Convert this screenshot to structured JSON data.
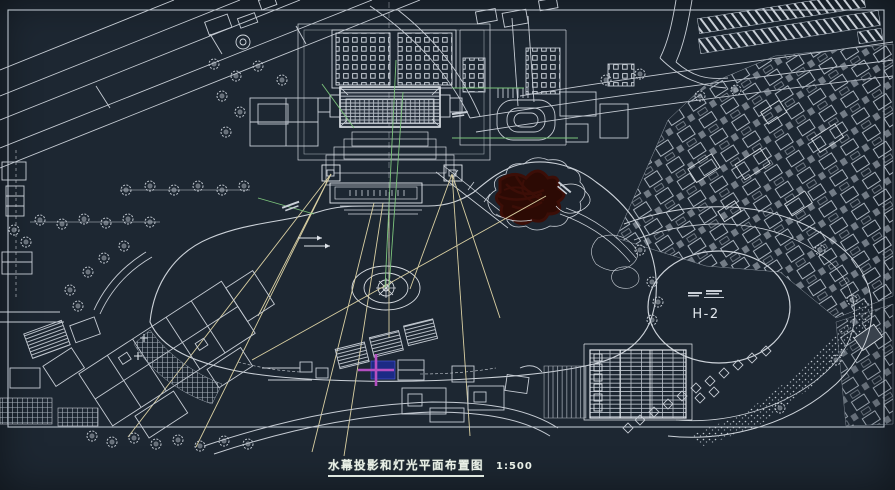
{
  "sheet": {
    "background": "#1d2732",
    "frame_color": "#b9c1ca"
  },
  "colors": {
    "line": "#c6ccd4",
    "bright_line": "#e6ebf0",
    "beam": "#d9cfa2",
    "projection_green": "#7cc47c",
    "tree_red": "#3c0e07",
    "tree_red_fill": "#2c0a04",
    "marker_blue": "#1c2a85",
    "marker_magenta": "#b44fc0",
    "title_text": "#e9efe7"
  },
  "annotations": {
    "plaza_label": "H-2"
  },
  "title_block": {
    "title": "水幕投影和灯光平面布置图",
    "scale": "1:500"
  }
}
